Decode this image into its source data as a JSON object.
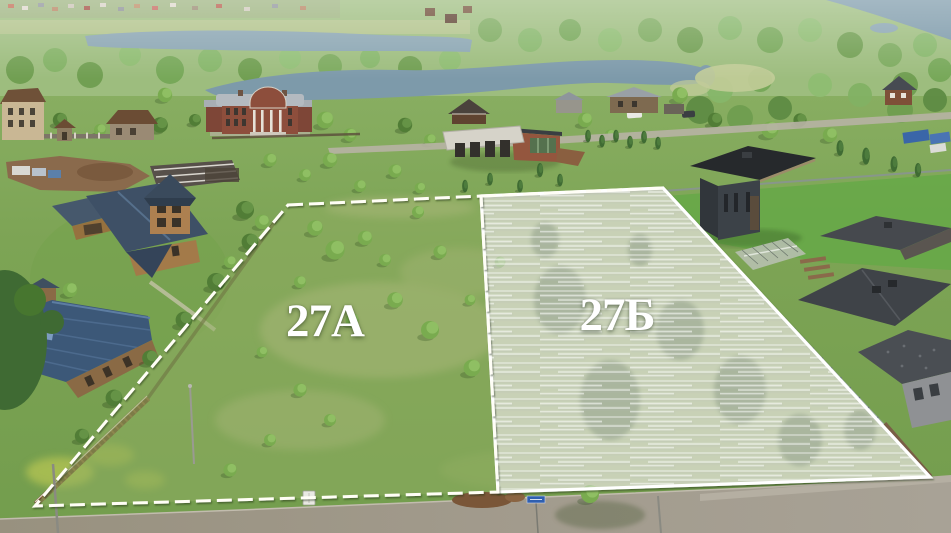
{
  "scene": {
    "title": "Aerial drone photo of two land plots by a lake",
    "plots": [
      {
        "id": "plot-a",
        "label": "27А",
        "highlighted": false
      },
      {
        "id": "plot-b",
        "label": "27Б",
        "highlighted": true
      }
    ],
    "annotation": {
      "boundary_color": "#fffef6",
      "highlight_fill": "rgba(255,255,255,0.45)",
      "label_color": "#ffffff"
    },
    "environment_colors": {
      "grass": "#7da455",
      "forest": "#6f9e50",
      "water": "#7d9aaa",
      "road": "#9d978b"
    }
  }
}
